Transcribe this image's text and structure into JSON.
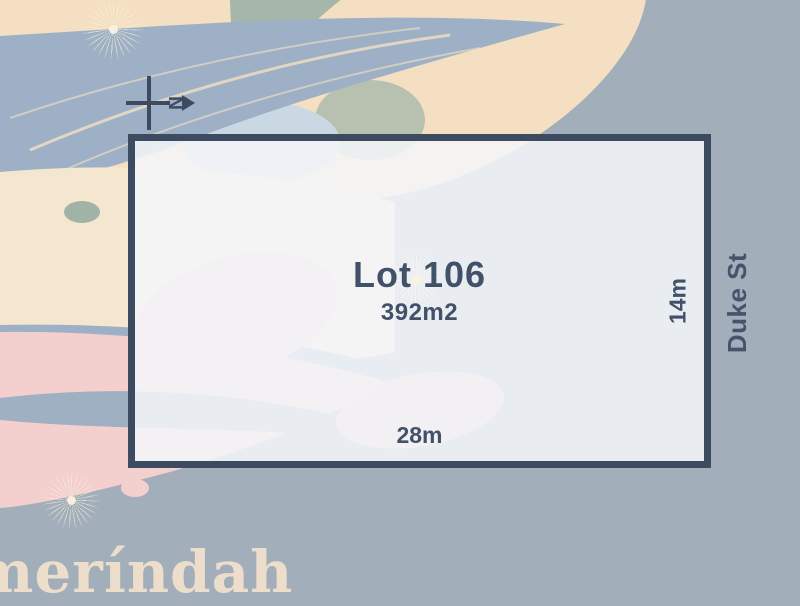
{
  "canvas": {
    "background_color": "#a3aebb"
  },
  "lot": {
    "title": "Lot 106",
    "area": "392m2",
    "frontage": "28m",
    "depth": "14m",
    "border_color": "#3c4b5f",
    "fill_color": "#eef1f5",
    "text_color": "#42516a"
  },
  "street": {
    "label": "Duke St",
    "color": "#45546b"
  },
  "compass": {
    "north_label": "N",
    "direction": "right",
    "color": "#3d4a5f"
  },
  "watermark": {
    "text": "meríndah",
    "color": "#ecdecb"
  },
  "palette": {
    "cream": "#f4dfc3",
    "sage_green": "#a4b7aa",
    "feather_blue": "#9db0c5",
    "pink": "#f3cfce",
    "pale_blue": "#c9d8e2",
    "starburst": "#f8f1d8"
  }
}
